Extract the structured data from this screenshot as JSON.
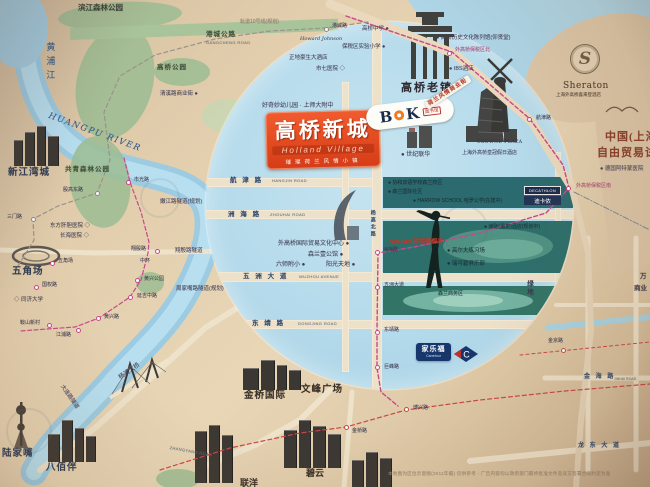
{
  "project": {
    "name": "高桥新城",
    "en": "Holland Village",
    "tagline": "璀璨荷兰风情小镇"
  },
  "logos": {
    "bok": {
      "b": "B",
      "k": "K",
      "tag": "图书馆"
    },
    "sheraton": {
      "initial": "S"
    },
    "carrefour": {
      "cn": "家乐福",
      "en": "Carrefour"
    },
    "decathlon": {
      "en": "DECATHLON",
      "cn": "迪卡侬"
    }
  },
  "map": {
    "labels": [
      {
        "t": "滨江森林公园",
        "x": 78,
        "y": 4,
        "c": "dk8"
      },
      {
        "t": "轨道10号线(规划)",
        "x": 240,
        "y": 20,
        "c": "gr5"
      },
      {
        "t": "港城公路",
        "x": 206,
        "y": 31,
        "c": "pk7"
      },
      {
        "t": "GANGCHENG ROAD",
        "x": 206,
        "y": 41,
        "c": "en4"
      },
      {
        "t": "高桥公园",
        "x": 157,
        "y": 64,
        "c": "pk7"
      },
      {
        "t": "清溪路商业街 ●",
        "x": 160,
        "y": 91,
        "c": "dk6"
      },
      {
        "t": "高桥中学 ●",
        "x": 362,
        "y": 26,
        "c": "dk6"
      },
      {
        "t": "保税区实验小学 ●",
        "x": 342,
        "y": 44,
        "c": "dk6"
      },
      {
        "t": "Howard Johnson",
        "x": 300,
        "y": 37,
        "c": "script5"
      },
      {
        "t": "正地豪生大酒店",
        "x": 289,
        "y": 55,
        "c": "dk6"
      },
      {
        "t": "市七医院 ◇",
        "x": 316,
        "y": 66,
        "c": "dk6"
      },
      {
        "t": "● 高桥历史文化陈列馆(仰贤堂)",
        "x": 436,
        "y": 35,
        "c": "dk6"
      },
      {
        "t": "● IBS酒店",
        "x": 449,
        "y": 66,
        "c": "dk6"
      },
      {
        "t": "高桥老镇",
        "x": 401,
        "y": 82,
        "c": "big11"
      },
      {
        "t": "荷兰风情商业街",
        "x": 424,
        "y": 103,
        "c": "banner",
        "rot": -33
      },
      {
        "t": "Sheraton",
        "x": 563,
        "y": 81,
        "c": "sher9"
      },
      {
        "t": "上海外高桥喜来登酒店",
        "x": 556,
        "y": 92,
        "c": "tiny45"
      },
      {
        "t": "中国(上海",
        "x": 605,
        "y": 131,
        "c": "ftz11"
      },
      {
        "t": "自由贸易试验区",
        "x": 597,
        "y": 147,
        "c": "ftz11"
      },
      {
        "t": "● 德国阿特蒙医院",
        "x": 600,
        "y": 166,
        "c": "dk6"
      },
      {
        "t": "好奇妙幼儿园 · 上师大附中",
        "x": 262,
        "y": 103,
        "c": "dk65"
      },
      {
        "t": "● 世纪联华",
        "x": 401,
        "y": 152,
        "c": "dk65"
      },
      {
        "t": "CROWNE PLAZA",
        "x": 477,
        "y": 140,
        "c": "cp45"
      },
      {
        "t": "上海外高桥皇冠假日酒店",
        "x": 462,
        "y": 151,
        "c": "dk55"
      },
      {
        "t": "航 津 路",
        "x": 230,
        "y": 177,
        "c": "road7"
      },
      {
        "t": "HANGJIN ROAD",
        "x": 272,
        "y": 179,
        "c": "en4"
      },
      {
        "t": "洲 海 路",
        "x": 228,
        "y": 211,
        "c": "road7"
      },
      {
        "t": "ZHOUHAI ROAD",
        "x": 270,
        "y": 213,
        "c": "en4"
      },
      {
        "t": "五 洲 大 道",
        "x": 243,
        "y": 273,
        "c": "road7"
      },
      {
        "t": "WUZHOU AVENUE",
        "x": 299,
        "y": 275,
        "c": "en4"
      },
      {
        "t": "东 靖 路",
        "x": 252,
        "y": 320,
        "c": "road7"
      },
      {
        "t": "DONGJING ROAD",
        "x": 298,
        "y": 322,
        "c": "en4"
      },
      {
        "t": "杨高北路",
        "x": 369,
        "y": 210,
        "c": "road55 vert"
      },
      {
        "t": "外高桥国际贸易文化中心 ●",
        "x": 278,
        "y": 241,
        "c": "dk65"
      },
      {
        "t": "森兰壹公馆 ●",
        "x": 308,
        "y": 252,
        "c": "dk65"
      },
      {
        "t": "六师附小 ●",
        "x": 276,
        "y": 262,
        "c": "dk65"
      },
      {
        "t": "阳光天地 ●",
        "x": 326,
        "y": 262,
        "c": "dk65"
      },
      {
        "t": "周家嘴路隧道(规划)",
        "x": 176,
        "y": 286,
        "c": "dk6"
      },
      {
        "t": "嫩江路隧道(规划)",
        "x": 160,
        "y": 199,
        "c": "dk6"
      },
      {
        "t": "新江湾城",
        "x": 8,
        "y": 168,
        "c": "place10"
      },
      {
        "t": "共青森林公园",
        "x": 65,
        "y": 166,
        "c": "pk7"
      },
      {
        "t": "东方肝胆医院 ◇",
        "x": 50,
        "y": 223,
        "c": "dk6"
      },
      {
        "t": "长海医院 ◇",
        "x": 60,
        "y": 233,
        "c": "dk6"
      },
      {
        "t": "五角场",
        "x": 12,
        "y": 267,
        "c": "place10"
      },
      {
        "t": "◇ 同济大学",
        "x": 14,
        "y": 297,
        "c": "dk6"
      },
      {
        "t": "翔殷路隧道",
        "x": 175,
        "y": 248,
        "c": "dk6"
      },
      {
        "t": "中环",
        "x": 140,
        "y": 259,
        "c": "dk55"
      },
      {
        "t": "杨浦大桥",
        "x": 118,
        "y": 376,
        "c": "dk65",
        "rot": -35
      },
      {
        "t": "大连路隧道",
        "x": 64,
        "y": 384,
        "c": "dk6",
        "rot": 55
      },
      {
        "t": "陆家嘴",
        "x": 2,
        "y": 449,
        "c": "place10"
      },
      {
        "t": "八佰伴",
        "x": 46,
        "y": 463,
        "c": "place10"
      },
      {
        "t": "金桥国际",
        "x": 244,
        "y": 391,
        "c": "big10"
      },
      {
        "t": "文峰广场",
        "x": 301,
        "y": 385,
        "c": "big10"
      },
      {
        "t": "联洋",
        "x": 240,
        "y": 478,
        "c": "big9"
      },
      {
        "t": "碧云",
        "x": 306,
        "y": 468,
        "c": "big9"
      },
      {
        "t": "ZHANGYANG ROAD",
        "x": 170,
        "y": 446,
        "c": "en4",
        "rot": 10
      },
      {
        "t": "金 海 路",
        "x": 584,
        "y": 374,
        "c": "road65"
      },
      {
        "t": "JINHAI ROAD",
        "x": 614,
        "y": 377,
        "c": "en35"
      },
      {
        "t": "龙 东 大 道",
        "x": 578,
        "y": 443,
        "c": "road65"
      },
      {
        "t": "万",
        "x": 640,
        "y": 273,
        "c": "dk7"
      },
      {
        "t": "商业",
        "x": 634,
        "y": 285,
        "c": "dk7"
      },
      {
        "t": "绿地",
        "x": 525,
        "y": 280,
        "c": "dk7 vert"
      },
      {
        "t": "森兰商务区",
        "x": 438,
        "y": 292,
        "c": "tl55"
      },
      {
        "t": "● 高尔夫练习场",
        "x": 447,
        "y": 248,
        "c": "tl6"
      },
      {
        "t": "● 瑞可碧俱乐部",
        "x": 447,
        "y": 261,
        "c": "tl6"
      },
      {
        "t": "● 洲际(温泉)酒店(规划中)",
        "x": 484,
        "y": 225,
        "c": "tl55"
      },
      {
        "t": "● 协和双语学校森兰校区",
        "x": 388,
        "y": 181,
        "c": "tl55"
      },
      {
        "t": "● 森兰国际社区",
        "x": 388,
        "y": 190,
        "c": "tl55"
      },
      {
        "t": "● HARROW SCHOOL 哈罗公学(在建中)",
        "x": 413,
        "y": 199,
        "c": "tl55"
      },
      {
        "t": "Auchan 欧尚旗舰店",
        "x": 389,
        "y": 239,
        "c": "auchan"
      },
      {
        "t": "黄浦江",
        "x": 44,
        "y": 42,
        "c": "river"
      },
      {
        "t": "HUANGPU RIVER",
        "x": 50,
        "y": 112,
        "c": "riverEn",
        "rot": 20
      },
      {
        "t": "本地图为区位示意图(2011年摄) 仅供参考 · 广告内容均以政府部门最终批准文件及双方签署合同约定为准",
        "x": 388,
        "y": 471,
        "c": "disc"
      }
    ],
    "stations": [
      {
        "t": "港城路",
        "x": 326,
        "y": 29,
        "lx": 332,
        "ly": 24,
        "k": "g"
      },
      {
        "t": "外高桥保税区北",
        "x": 449,
        "y": 53,
        "lx": 455,
        "ly": 48,
        "k": "",
        "p": 1
      },
      {
        "t": "航津路",
        "x": 529,
        "y": 119,
        "lx": 536,
        "ly": 116,
        "k": ""
      },
      {
        "t": "外高桥保税区南",
        "x": 568,
        "y": 188,
        "lx": 576,
        "ly": 184,
        "k": "",
        "p": 1
      },
      {
        "t": "洲海路",
        "x": 377,
        "y": 252,
        "lx": 383,
        "ly": 248,
        "k": ""
      },
      {
        "t": "五洲大道",
        "x": 377,
        "y": 287,
        "lx": 384,
        "ly": 283,
        "k": ""
      },
      {
        "t": "东靖路",
        "x": 377,
        "y": 332,
        "lx": 384,
        "ly": 328,
        "k": ""
      },
      {
        "t": "巨峰路",
        "x": 377,
        "y": 367,
        "lx": 384,
        "ly": 365,
        "k": ""
      },
      {
        "t": "博兴路",
        "x": 406,
        "y": 409,
        "lx": 413,
        "ly": 406,
        "k": "r"
      },
      {
        "t": "金桥路",
        "x": 346,
        "y": 427,
        "lx": 352,
        "ly": 429,
        "k": "r"
      },
      {
        "t": "金京路",
        "x": 563,
        "y": 350,
        "lx": 548,
        "ly": 339,
        "k": "r"
      },
      {
        "t": "三门路",
        "x": 33,
        "y": 219,
        "lx": 7,
        "ly": 215,
        "k": "g"
      },
      {
        "t": "殷高东路",
        "x": 97,
        "y": 193,
        "lx": 63,
        "ly": 188,
        "k": "g"
      },
      {
        "t": "市光路",
        "x": 128,
        "y": 182,
        "lx": 134,
        "ly": 178,
        "k": ""
      },
      {
        "t": "翔殷路",
        "x": 157,
        "y": 251,
        "lx": 131,
        "ly": 247,
        "k": ""
      },
      {
        "t": "黄兴公园",
        "x": 137,
        "y": 280,
        "lx": 144,
        "ly": 277,
        "k": ""
      },
      {
        "t": "延吉中路",
        "x": 130,
        "y": 297,
        "lx": 137,
        "ly": 294,
        "k": ""
      },
      {
        "t": "黄兴路",
        "x": 98,
        "y": 318,
        "lx": 104,
        "ly": 315,
        "k": ""
      },
      {
        "t": "鞍山新村",
        "x": 49,
        "y": 325,
        "lx": 20,
        "ly": 321,
        "k": ""
      },
      {
        "t": "江浦路",
        "x": 78,
        "y": 330,
        "lx": 56,
        "ly": 333,
        "k": ""
      },
      {
        "t": "国权路",
        "x": 36,
        "y": 287,
        "lx": 42,
        "ly": 283,
        "k": ""
      },
      {
        "t": "五角场",
        "x": 52,
        "y": 263,
        "lx": 58,
        "ly": 259,
        "k": ""
      }
    ],
    "lines": [
      {
        "c": "#ead9bd",
        "w": 9,
        "pts": [
          [
            330,
            4
          ],
          [
            455,
            54
          ],
          [
            532,
            122
          ],
          [
            571,
            186
          ]
        ]
      },
      {
        "c": "#e6d5b9",
        "w": 6,
        "pts": [
          [
            571,
            186
          ],
          [
            588,
            252
          ],
          [
            591,
            330
          ],
          [
            581,
            420
          ],
          [
            576,
            487
          ]
        ]
      },
      {
        "c": "#7d8894",
        "w": 1,
        "dash": "6 2 1 2",
        "pts": [
          [
            574,
            192
          ],
          [
            650,
            230
          ]
        ]
      },
      {
        "c": "#c9488a",
        "w": 1.4,
        "dash": "4 2.5",
        "pts": [
          [
            346,
            16
          ],
          [
            452,
            52
          ],
          [
            530,
            119
          ],
          [
            563,
            165
          ],
          [
            569,
            188
          ],
          [
            546,
            213
          ],
          [
            480,
            233
          ],
          [
            414,
            247
          ],
          [
            378,
            253
          ],
          [
            377,
            330
          ],
          [
            377,
            368
          ],
          [
            381,
            392
          ],
          [
            398,
            406
          ]
        ]
      },
      {
        "c": "#cc4545",
        "w": 1.2,
        "dash": "4 3",
        "pts": [
          [
            160,
            470
          ],
          [
            230,
            448
          ],
          [
            300,
            433
          ],
          [
            346,
            427
          ],
          [
            406,
            410
          ],
          [
            480,
            400
          ],
          [
            565,
            391
          ],
          [
            650,
            384
          ]
        ]
      },
      {
        "c": "#cc4545",
        "w": 1,
        "dash": "3 3",
        "pts": [
          [
            520,
            355
          ],
          [
            650,
            342
          ]
        ]
      },
      {
        "c": "#9a938a",
        "w": 1.2,
        "dash": "4 3",
        "pts": [
          [
            18,
            266
          ],
          [
            34,
            240
          ],
          [
            33,
            219
          ],
          [
            58,
            206
          ],
          [
            97,
            193
          ],
          [
            110,
            160
          ],
          [
            104,
            112
          ],
          [
            120,
            76
          ],
          [
            155,
            55
          ],
          [
            215,
            39
          ],
          [
            270,
            31
          ],
          [
            326,
            28
          ],
          [
            368,
            22
          ]
        ]
      },
      {
        "c": "#c9488a",
        "w": 1.2,
        "dash": "4 2.5",
        "pts": [
          [
            124,
            158
          ],
          [
            130,
            182
          ],
          [
            141,
            212
          ],
          [
            149,
            242
          ],
          [
            148,
            253
          ],
          [
            141,
            280
          ],
          [
            130,
            297
          ],
          [
            99,
            318
          ],
          [
            75,
            327
          ],
          [
            20,
            331
          ]
        ]
      }
    ]
  }
}
